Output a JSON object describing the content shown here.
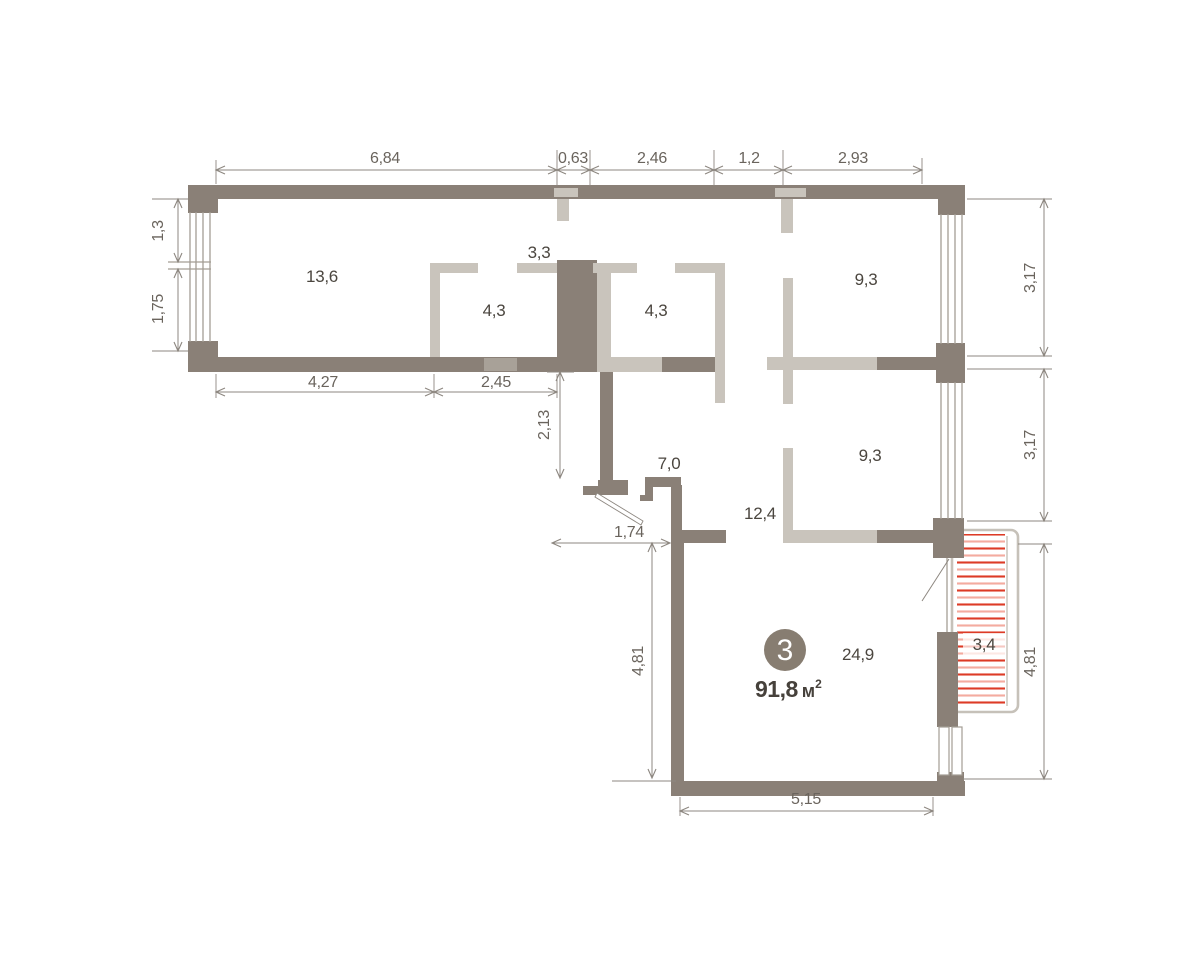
{
  "plan": {
    "badge": {
      "number": "3",
      "area": "91,8",
      "unit": "м",
      "unit_sup": "2"
    },
    "rooms": {
      "r136": "13,6",
      "r33": "3,3",
      "r43a": "4,3",
      "r43b": "4,3",
      "r93a": "9,3",
      "r93b": "9,3",
      "r124": "12,4",
      "r70": "7,0",
      "r249": "24,9",
      "r34": "3,4"
    },
    "dims": {
      "top1": "6,84",
      "top2": "0,63",
      "top3": "2,46",
      "top4": "1,2",
      "top5": "2,93",
      "left1": "1,3",
      "left2": "1,75",
      "wing1": "4,27",
      "wing2": "2,45",
      "mid1": "2,13",
      "door1": "1,74",
      "lower_left": "4,81",
      "bottom": "5,15",
      "right1": "3,17",
      "right2": "3,17",
      "right3": "4,81"
    },
    "colors": {
      "wall_dark": "#8a8077",
      "wall_light": "#c9c4bc",
      "dim_line": "#8d8780",
      "dim_text": "#6a645d",
      "room_text": "#4b463f",
      "hatch_strong": "#dd3b26",
      "hatch_light": "#f4ab9f",
      "badge_bg": "#877d71"
    }
  }
}
